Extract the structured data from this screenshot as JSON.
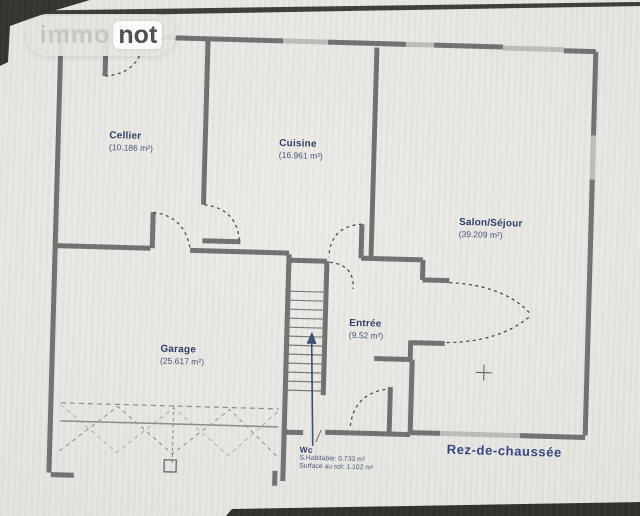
{
  "watermark": {
    "immo": "immo",
    "not": "not"
  },
  "plan": {
    "title": "Rez-de-chaussée",
    "rooms": [
      {
        "id": "cellier",
        "name": "Cellier",
        "area": "(10.186 m²)"
      },
      {
        "id": "cuisine",
        "name": "Cuisine",
        "area": "(16.961 m²)"
      },
      {
        "id": "salon-sejour",
        "name": "Salon/Séjour",
        "area": "(39.209 m²)"
      },
      {
        "id": "garage",
        "name": "Garage",
        "area": "(25.617 m²)"
      },
      {
        "id": "entree",
        "name": "Entrée",
        "area": "(9.52 m²)"
      },
      {
        "id": "wc",
        "name": "Wc"
      }
    ],
    "wc_details": [
      "S.Habitable: 0.733 m²",
      "Surface au sol: 1.102 m²"
    ]
  },
  "colors": {
    "label_ink": "#2c3a63",
    "wall": "#6f6f6f",
    "window": "#bdbcb7",
    "stair_arrow": "#3b4c72",
    "paper": "#e6e5e1"
  }
}
